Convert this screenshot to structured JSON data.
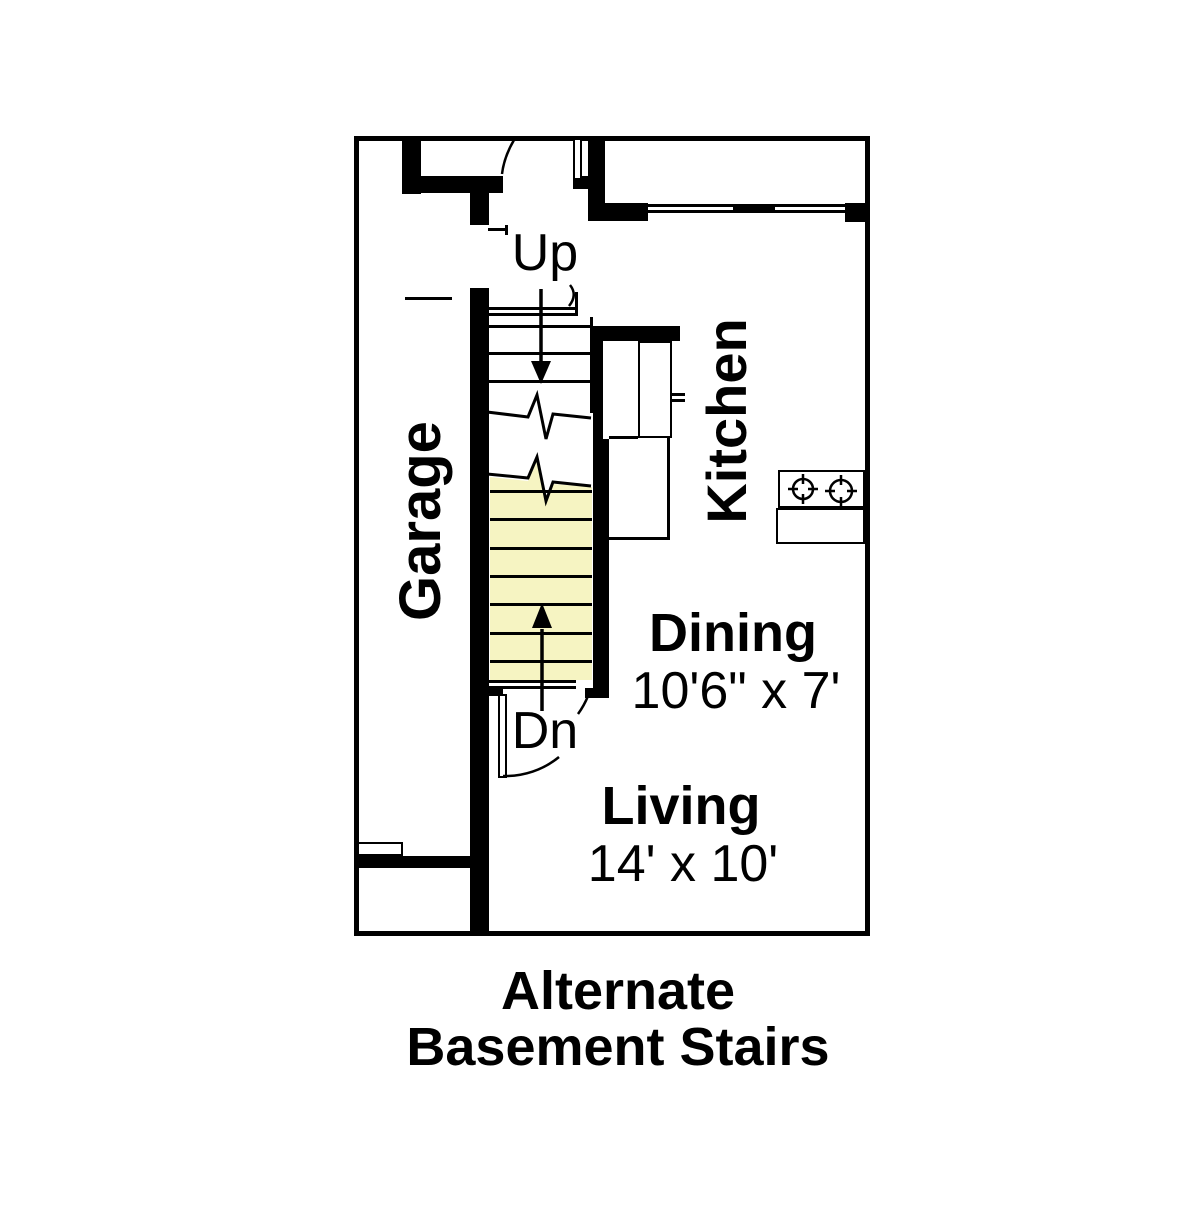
{
  "caption": {
    "line1": "Alternate",
    "line2": "Basement Stairs"
  },
  "rooms": {
    "garage": {
      "label": "Garage"
    },
    "kitchen": {
      "label": "Kitchen"
    },
    "dining": {
      "label": "Dining",
      "dimensions": "10'6\" x 7'"
    },
    "living": {
      "label": "Living",
      "dimensions": "14' x 10'"
    }
  },
  "stairs": {
    "up_label": "Up",
    "down_label": "Dn"
  },
  "icons": {
    "cooktop": "cooktop-two-burners-icon",
    "up_arrow": "up-stair-direction-arrow",
    "down_arrow": "down-stair-direction-arrow"
  },
  "colors": {
    "line": "#000000",
    "stair_fill": "#F6F4C2",
    "background": "#FFFFFF"
  }
}
